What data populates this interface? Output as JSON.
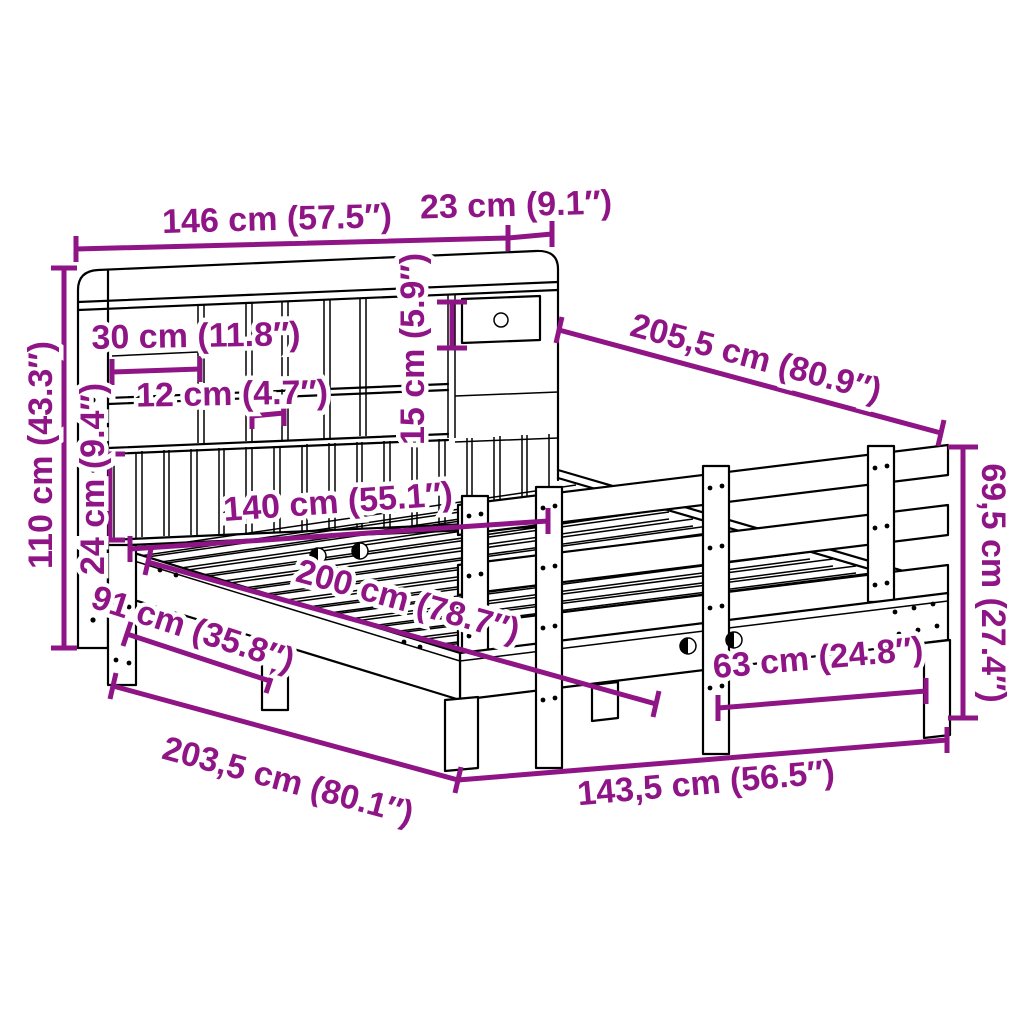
{
  "diagram": {
    "type": "furniture-dimension-diagram",
    "subject": "bookcase-bed-line-drawing",
    "colors": {
      "annotation": "#8F1586",
      "line_art": "#000000",
      "background": "#FFFFFF"
    },
    "dims": [
      {
        "name": "headboard-width",
        "label": "146 cm (57.5″)"
      },
      {
        "name": "side-shelf-width",
        "label": "23 cm (9.1″)"
      },
      {
        "name": "compartment-width",
        "label": "30 cm (11.8″)"
      },
      {
        "name": "niche-width",
        "label": "12 cm (4.7″)"
      },
      {
        "name": "drawer-height",
        "label": "15 cm (5.9″)"
      },
      {
        "name": "slat-panel-height",
        "label": "24 cm (9.4″)"
      },
      {
        "name": "headboard-height",
        "label": "110 cm (43.3″)"
      },
      {
        "name": "total-length",
        "label": "205,5 cm (80.9″)"
      },
      {
        "name": "footboard-height",
        "label": "69,5 cm (27.4″)"
      },
      {
        "name": "inner-width",
        "label": "140 cm (55.1″)"
      },
      {
        "name": "inner-length",
        "label": "200 cm (78.7″)"
      },
      {
        "name": "front-leg-span",
        "label": "91 cm (35.8″)"
      },
      {
        "name": "frame-length",
        "label": "203,5 cm (80.1″)"
      },
      {
        "name": "foot-leg-span",
        "label": "63 cm (24.8″)"
      },
      {
        "name": "frame-width",
        "label": "143,5 cm (56.5″)"
      }
    ]
  }
}
